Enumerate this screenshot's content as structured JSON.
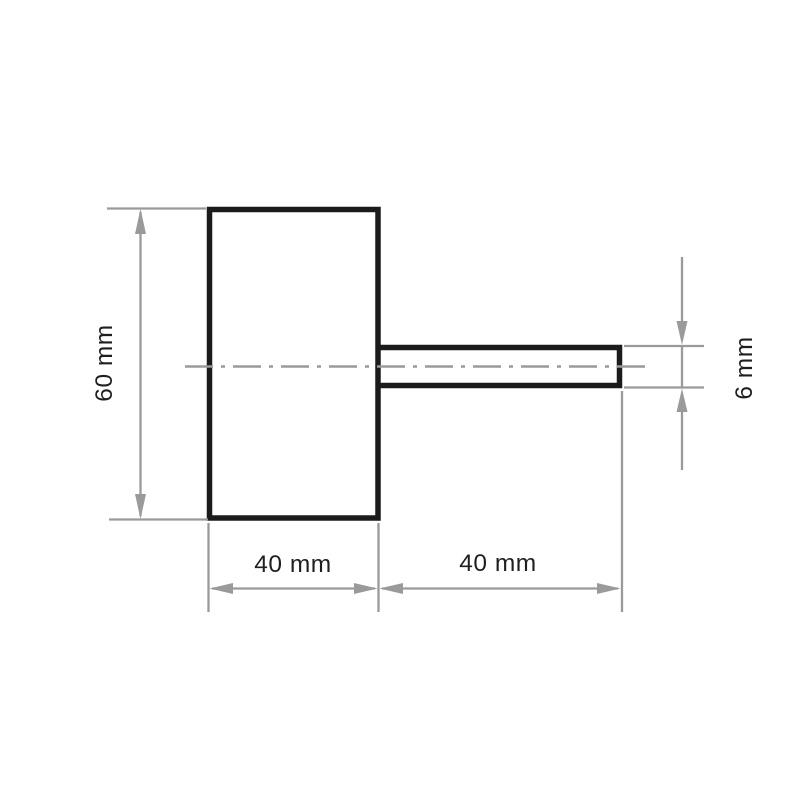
{
  "drawing": {
    "labels": {
      "body_height": "60 mm",
      "body_width": "40 mm",
      "shank_length": "40 mm",
      "shank_diameter": "6 mm"
    },
    "colors": {
      "outline": "#1b1b1b",
      "dimension_lines": "#9a9a9a",
      "label_text": "#1f1f1f",
      "background": "#ffffff"
    }
  }
}
